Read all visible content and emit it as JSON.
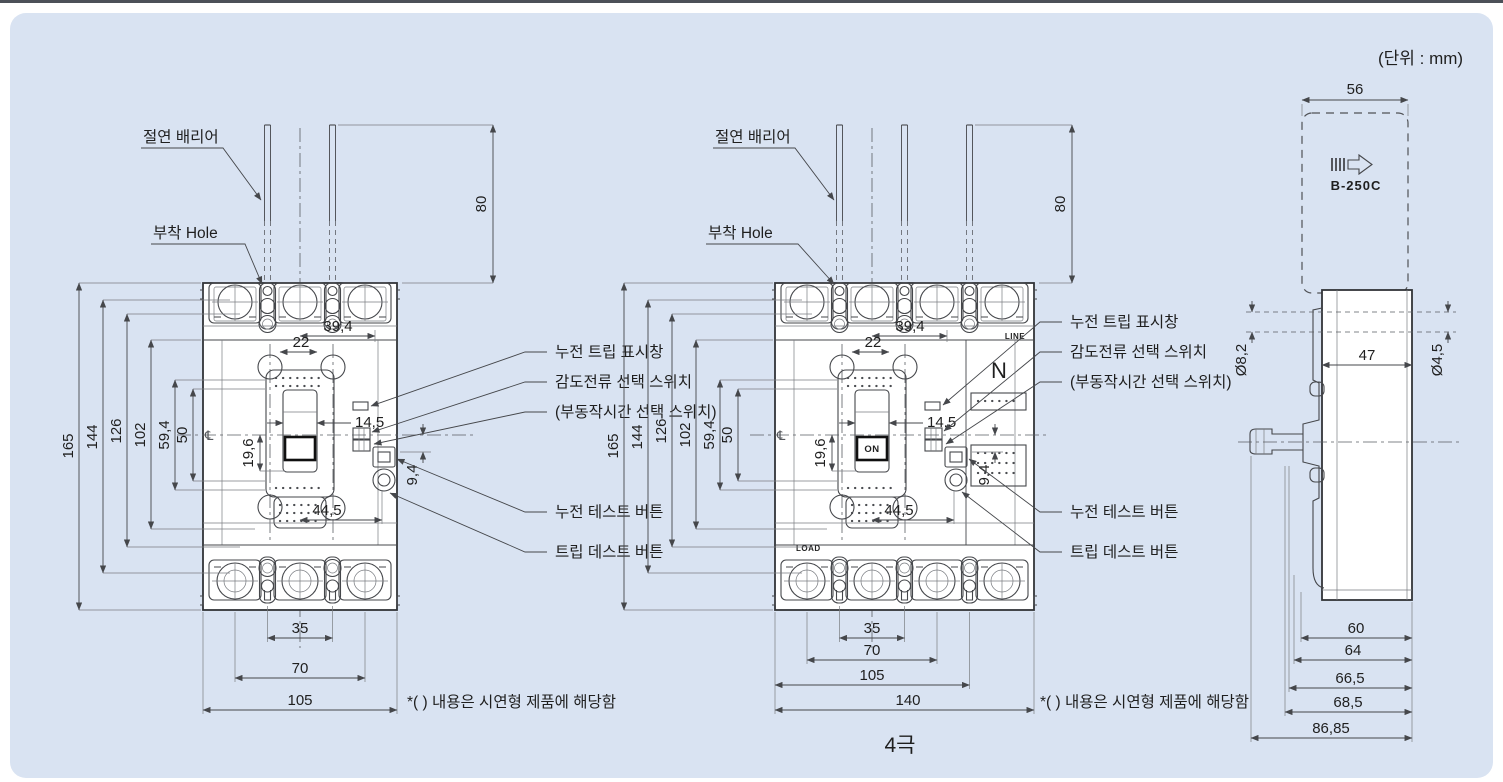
{
  "page": {
    "unit_label": "(단위 : mm)",
    "footnote": "*( ) 내용은 시연형 제품에 해당함",
    "caption_4pole": "4극"
  },
  "labels": {
    "insulation_barrier": "절연 배리어",
    "mounting_hole": "부착 Hole",
    "leakage_trip_window": "누전 트립 표시창",
    "sensitivity_current_switch": "감도전류 선택 스위치",
    "delay_time_switch": "(부동작시간 선택 스위치)",
    "leakage_test_button": "누전 테스트 버튼",
    "trip_test_button": "트립 데스트 버튼"
  },
  "dims": {
    "h165": "165",
    "h144": "144",
    "h126": "126",
    "h102": "102",
    "h59_4": "59,4",
    "h50": "50",
    "h19_6": "19,6",
    "w39_4": "39,4",
    "w22": "22",
    "w14_5": "14,5",
    "h9_4": "9,4",
    "w44_5": "44,5",
    "w35": "35",
    "w70": "70",
    "w105": "105",
    "barrier_h80": "80",
    "centerline_symbol": "℄"
  },
  "front4": {
    "w140": "140",
    "n_pole": "N",
    "line_label": "LINE",
    "load_label": "LOAD",
    "on_label": "ON"
  },
  "side": {
    "model": "B-250C",
    "w56": "56",
    "d8_2": "Ø8,2",
    "w47": "47",
    "d4_5": "Ø4,5",
    "w60": "60",
    "w64": "64",
    "w66_5": "66,5",
    "w68_5": "68,5",
    "w86_85": "86,85"
  }
}
